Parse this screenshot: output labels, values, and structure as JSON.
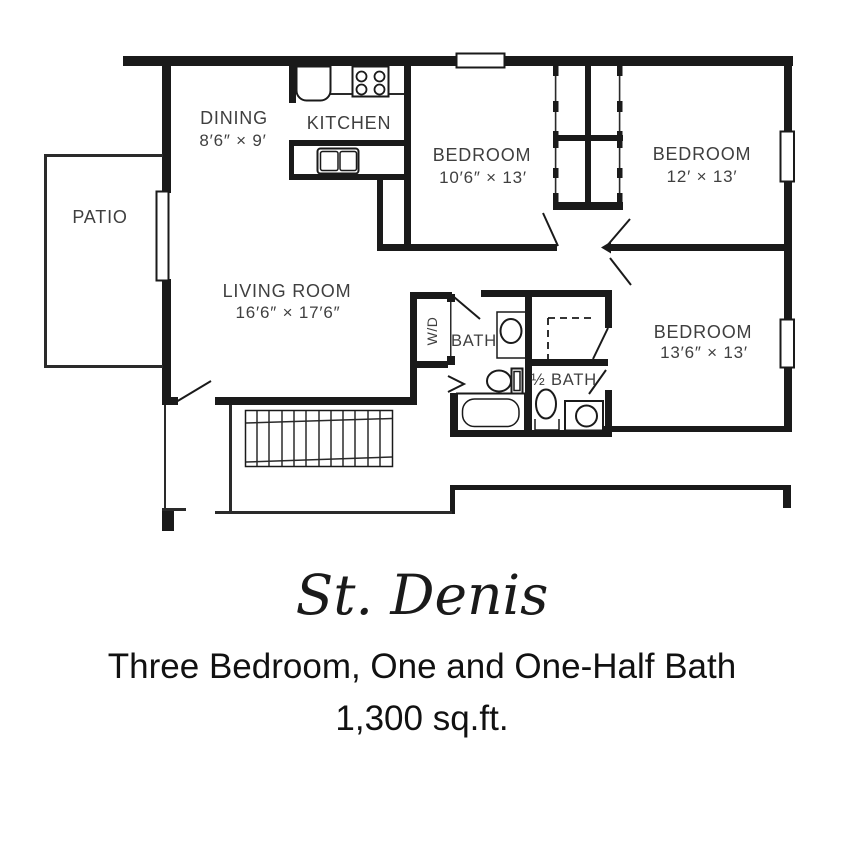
{
  "colors": {
    "wall": "#1a1a1a",
    "room_label": "#3f3f3f",
    "title_text": "#111111",
    "background": "#ffffff"
  },
  "plan": {
    "rooms": {
      "dining": {
        "label": "DINING",
        "dims": "8′6″ × 9′"
      },
      "kitchen": {
        "label": "KITCHEN"
      },
      "patio": {
        "label": "PATIO"
      },
      "bedroom_top_left": {
        "label": "BEDROOM",
        "dims": "10′6″ × 13′"
      },
      "bedroom_top_right": {
        "label": "BEDROOM",
        "dims": "12′ × 13′"
      },
      "living_room": {
        "label": "LIVING ROOM",
        "dims": "16′6″ × 17′6″"
      },
      "bedroom_bottom_right": {
        "label": "BEDROOM",
        "dims": "13′6″ × 13′"
      },
      "bath": {
        "label": "BATH"
      },
      "half_bath": {
        "label": "½ BATH"
      },
      "washer_dryer": {
        "label": "W/D"
      }
    }
  },
  "title": {
    "name": "St. Denis",
    "subtitle": "Three Bedroom, One and One-Half Bath",
    "area": "1,300 sq.ft."
  }
}
